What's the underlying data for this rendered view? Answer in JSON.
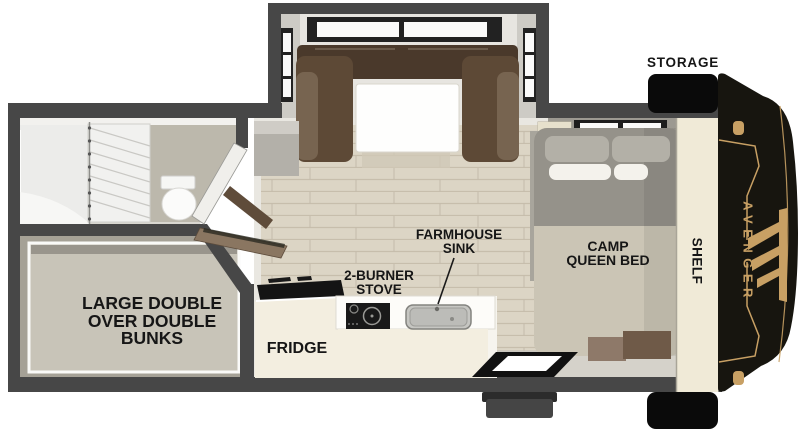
{
  "title": "Avenger travel trailer floorplan",
  "labels": {
    "storage": "STORAGE",
    "camp_queen_bed": [
      "CAMP",
      "QUEEN BED"
    ],
    "shelf": "SHELF",
    "farmhouse_sink": [
      "FARMHOUSE",
      "SINK"
    ],
    "stove": [
      "2-BURNER",
      "STOVE"
    ],
    "fridge": "FRIDGE",
    "bunks": [
      "LARGE DOUBLE",
      "OVER DOUBLE",
      "BUNKS"
    ],
    "brand": "AVENGER"
  },
  "icons": {
    "front_cap": "avenger-front-cap",
    "eagle_logo": "eagle-wing-logo",
    "entry_step": "entry-step",
    "entry_door_mat": "entry-door-opening",
    "storage_boxes": "exterior-storage-compartments"
  },
  "colors": {
    "wall": "#474747",
    "label_text": "#161616",
    "brand_gold": "#c8a064",
    "cap_black": "#17150f",
    "storage_black": "#0a0a0a",
    "floor": "#dcd5c5",
    "plank_line": "#c7beac",
    "cream_cabinet": "#f3eee0",
    "dinette_brown": "#5d4936",
    "dinette_dark": "#4a392b",
    "dinette_arm": "#776450",
    "bed_gray": "#95928a",
    "bed_beige": "#cbc5b5",
    "bunk_mattress": "#c8c4b8",
    "shelf_cream": "#f0ead7"
  }
}
